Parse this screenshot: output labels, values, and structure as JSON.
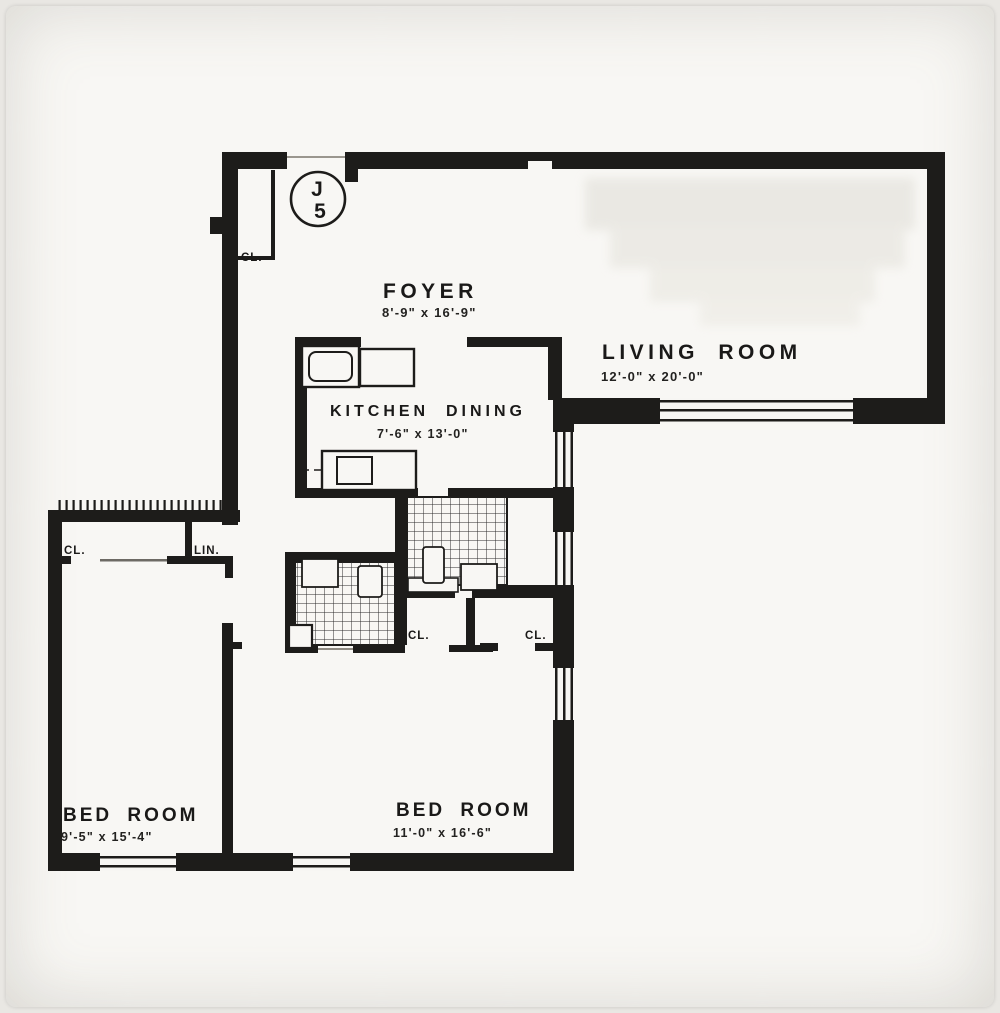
{
  "document": {
    "type": "apartment-floor-plan",
    "unit_badge": {
      "letter": "J",
      "number": "5"
    }
  },
  "rooms": {
    "foyer": {
      "name": "FOYER",
      "dims": "8'-9\" x 16'-9\""
    },
    "living_room": {
      "name": "LIVING ROOM",
      "dims": "12'-0\" x 20'-0\""
    },
    "kitchen_dining": {
      "kitchen": "KITCHEN",
      "dining": "DINING",
      "dims": "7'-6\" x 13'-0\""
    },
    "bedroom_1": {
      "name": "BED ROOM",
      "dims": "9'-5\" x 15'-4\""
    },
    "bedroom_2": {
      "name": "BED ROOM",
      "dims": "11'-0\" x 16'-6\""
    }
  },
  "closets": {
    "foyer_closet": "CL.",
    "bedroom_1_closet": "CL.",
    "linen_closet": "LIN.",
    "bedroom_2_closet_left": "CL.",
    "bedroom_2_closet_right": "CL."
  },
  "colors": {
    "wall": "#1d1c1a",
    "paper": "#f7f6f3",
    "tile_line": "#2b2b2b"
  }
}
